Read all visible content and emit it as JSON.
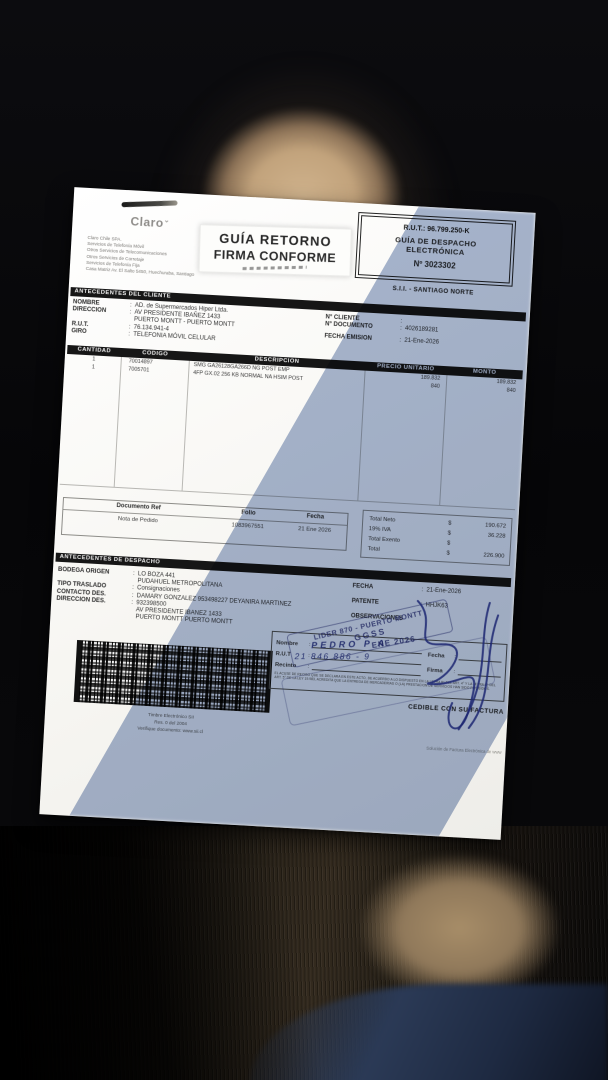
{
  "colors": {
    "paper": "#f7f6f2",
    "shadow_tint": "#7087b2",
    "ink": "#2b2b2b",
    "stamp_ink": "#2a3580",
    "seat": "#cfb28c",
    "fabric": "#332a1e",
    "fabric_lit": "#a78d68",
    "fabric_navy": "#2b3a56"
  },
  "punct": {
    "colon": ":",
    "currency": "$"
  },
  "header": {
    "logo": "Claro",
    "company_lines": [
      "Claro Chile SPA.",
      "Servicios de Telefonía Móvil",
      "Otros Servicios de Telecomunicaciones",
      "Otros Servicios de Corretaje",
      "Servicios de Telefonía Fija",
      "Casa Matriz Av. El Salto 5450, Huechuraba, Santiago"
    ],
    "sticker_line1": "GUÍA RETORNO",
    "sticker_line2": "FIRMA CONFORME",
    "rut": "R.U.T.: 96.799.250-K",
    "doc_title1": "GUÍA DE DESPACHO",
    "doc_title2": "ELECTRÓNICA",
    "doc_number": "Nº 3023302",
    "sii_office": "S.I.I. - SANTIAGO NORTE"
  },
  "client": {
    "title": "ANTECEDENTES DEL CLIENTE",
    "rows": [
      {
        "label": "NOMBRE",
        "sep": ":",
        "value": "AD. de Supermercados Hiper Ltda."
      },
      {
        "label": "DIRECCION",
        "sep": ":",
        "value": "AV PRESIDENTE IBAÑEZ 1433"
      },
      {
        "label": "",
        "sep": "",
        "value": "PUERTO MONTT -  PUERTO MONTT"
      },
      {
        "label": "R.U.T.",
        "sep": ":",
        "value": "76.134.941-4"
      },
      {
        "label": "GIRO",
        "sep": ":",
        "value": "TELEFONIA MÓVIL CELULAR"
      }
    ],
    "right_rows": [
      {
        "label": "N° CLIENTE",
        "sep": ":",
        "value": ""
      },
      {
        "label": "N° DOCUMENTO",
        "sep": ":",
        "value": "4026189281"
      },
      {
        "label": "FECHA EMISION",
        "sep": ":",
        "value": "21-Ene-2026"
      }
    ]
  },
  "items": {
    "columns": [
      "CANTIDAD",
      "CODIGO",
      "DESCRIPCION",
      "PRECIO UNITARIO",
      "MONTO"
    ],
    "rows": [
      {
        "cantidad": "1",
        "codigo": "70014897",
        "descripcion": "SMG GA26128GA266D NG POST EMP",
        "precio_unitario": "189.832",
        "monto": "189.832"
      },
      {
        "cantidad": "1",
        "codigo": "7005701",
        "descripcion": "4FP GX.02 256 KB NORMAL NA HSIM POST",
        "precio_unitario": "840",
        "monto": "840"
      }
    ]
  },
  "docref": {
    "headers": [
      "Documento Ref",
      "Folio",
      "Fecha"
    ],
    "values": [
      "Nota de Pedido",
      "1083967551",
      "21 Ene 2026"
    ]
  },
  "totals": {
    "rows": [
      {
        "label": "Total Neto",
        "sign": "$",
        "value": "190.672"
      },
      {
        "label": "19% IVA",
        "sign": "$",
        "value": "36.228"
      },
      {
        "label": "Total Exento",
        "sign": "$",
        "value": ""
      },
      {
        "label": "Total",
        "sign": "$",
        "value": "226.900"
      }
    ]
  },
  "despacho": {
    "title": "ANTECEDENTES DE DESPACHO",
    "left_rows": [
      {
        "label": "BODEGA ORIGEN",
        "sep": ":",
        "value": "LO BOZA 441"
      },
      {
        "label": "",
        "sep": "",
        "value": "PUDAHUEL  METROPOLITANA"
      },
      {
        "label": "TIPO TRASLADO",
        "sep": ":",
        "value": "Consignaciones"
      },
      {
        "label": "CONTACTO DES.",
        "sep": ":",
        "value": "DAMARY GONZALEZ 953498227 DEYANIRA MARTINEZ"
      },
      {
        "label": "DIRECCION DES.",
        "sep": ":",
        "value": "932398500"
      },
      {
        "label": "",
        "sep": "",
        "value": "AV PRESIDENTE IBANEZ 1433"
      },
      {
        "label": "",
        "sep": "",
        "value": "PUERTO MONTT  PUERTO MONTT"
      }
    ],
    "right_rows": [
      {
        "label": "FECHA",
        "sep": ":",
        "value": "21-Ene-2026"
      },
      {
        "label": "PATENTE",
        "sep": ":",
        "value": "HHJK63"
      },
      {
        "label": "OBSERVACIONES",
        "sep": "",
        "value": ""
      }
    ]
  },
  "barcode": {
    "captions": [
      "Timbre Electrónico SII",
      "Res. 0 del 2004",
      "Verifique documento: www.sii.cl"
    ]
  },
  "receipt": {
    "fields": [
      "Nombre",
      "R.U.T",
      "Recinto"
    ],
    "right_fields": [
      "Fecha",
      "Firma"
    ],
    "handwritten_name": "PEDRO P A",
    "handwritten_rut": "21 846 886 - 9",
    "stamp_line1": "LIDER 870 - PUERTO MONTT",
    "stamp_line2": "GGSS",
    "date_stamp": "ENE 2026",
    "legal_text": "EL ACUSE DE RECIBO QUE SE DECLARA EN ESTE ACTO, DE ACUERDO A LO DISPUESTO EN LA LETRA B) DEL ART. 4° Y LA LETRA C) DEL ART. 5° DE LA LEY 19.983, ACREDITA QUE LA ENTREGA DE MERCADERIAS O (LA) PRESTACION DE SERVICIOS HAN SIDO RECIBIDOS.",
    "cedible": "CEDIBLE CON SU FACTURA"
  },
  "footer_note": "Solución de Factura Electrónica de www"
}
